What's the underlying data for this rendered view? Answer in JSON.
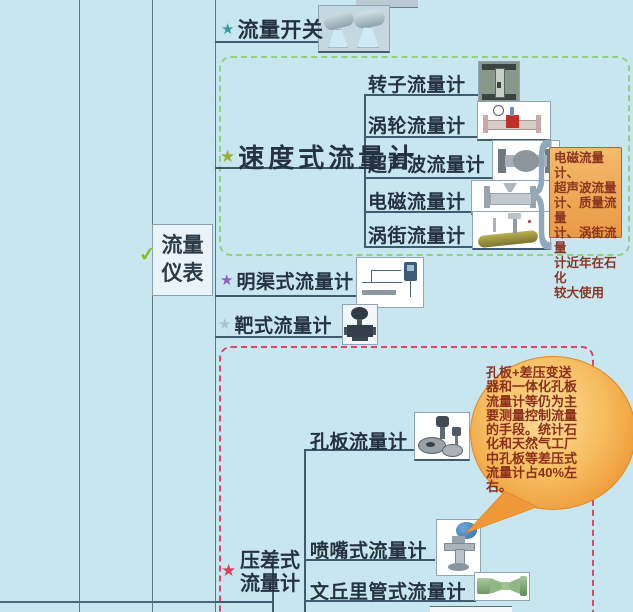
{
  "page": {
    "background_color": "#C8E6F0",
    "line_color": "#3E5C6E"
  },
  "icons": {
    "star": "★",
    "check": "✔",
    "brace": "{"
  },
  "root": {
    "label": "流量\n仪表",
    "check_icon_color": "#7FC241"
  },
  "branches": {
    "flow_switch": {
      "label": "流量开关",
      "star_color": "#2E9E9E"
    },
    "velocity": {
      "label": "速度式流量计",
      "star_color": "#9AAE35",
      "border_color": "#8ED47E",
      "children": [
        {
          "label": "转子流量计"
        },
        {
          "label": "涡轮流量计"
        },
        {
          "label": "超声波流量计"
        },
        {
          "label": "电磁流量计"
        },
        {
          "label": "涡街流量计"
        }
      ],
      "note": {
        "text": "电磁流量计、\n超声波流量\n计、质量流量\n计、涡街流量\n计近年在石化\n较大使用",
        "bg_color": "#EFA758",
        "border_color": "#A8663A",
        "text_color": "#8B3520"
      }
    },
    "open_channel": {
      "label": "明渠式流量计",
      "star_color": "#8F5FC2"
    },
    "target": {
      "label": "靶式流量计",
      "star_color": "#AEC2CC"
    },
    "diff_pressure": {
      "label": "压差式\n流量计",
      "star_color": "#D8435A",
      "border_color": "#D84868",
      "children": [
        {
          "label": "孔板流量计"
        },
        {
          "label": "喷嘴式流量计"
        },
        {
          "label": "文丘里管式流量计"
        }
      ],
      "callout": {
        "text": "孔板+差压变送\n器和一体化孔板\n流量计等仍为主\n要测量控制流量\n的手段。统计石\n化和天然气工厂\n中孔板等差压式\n流量计占40%左\n右。",
        "bg_color": "#F2A94E",
        "text_color": "#8C2F1A"
      }
    }
  }
}
